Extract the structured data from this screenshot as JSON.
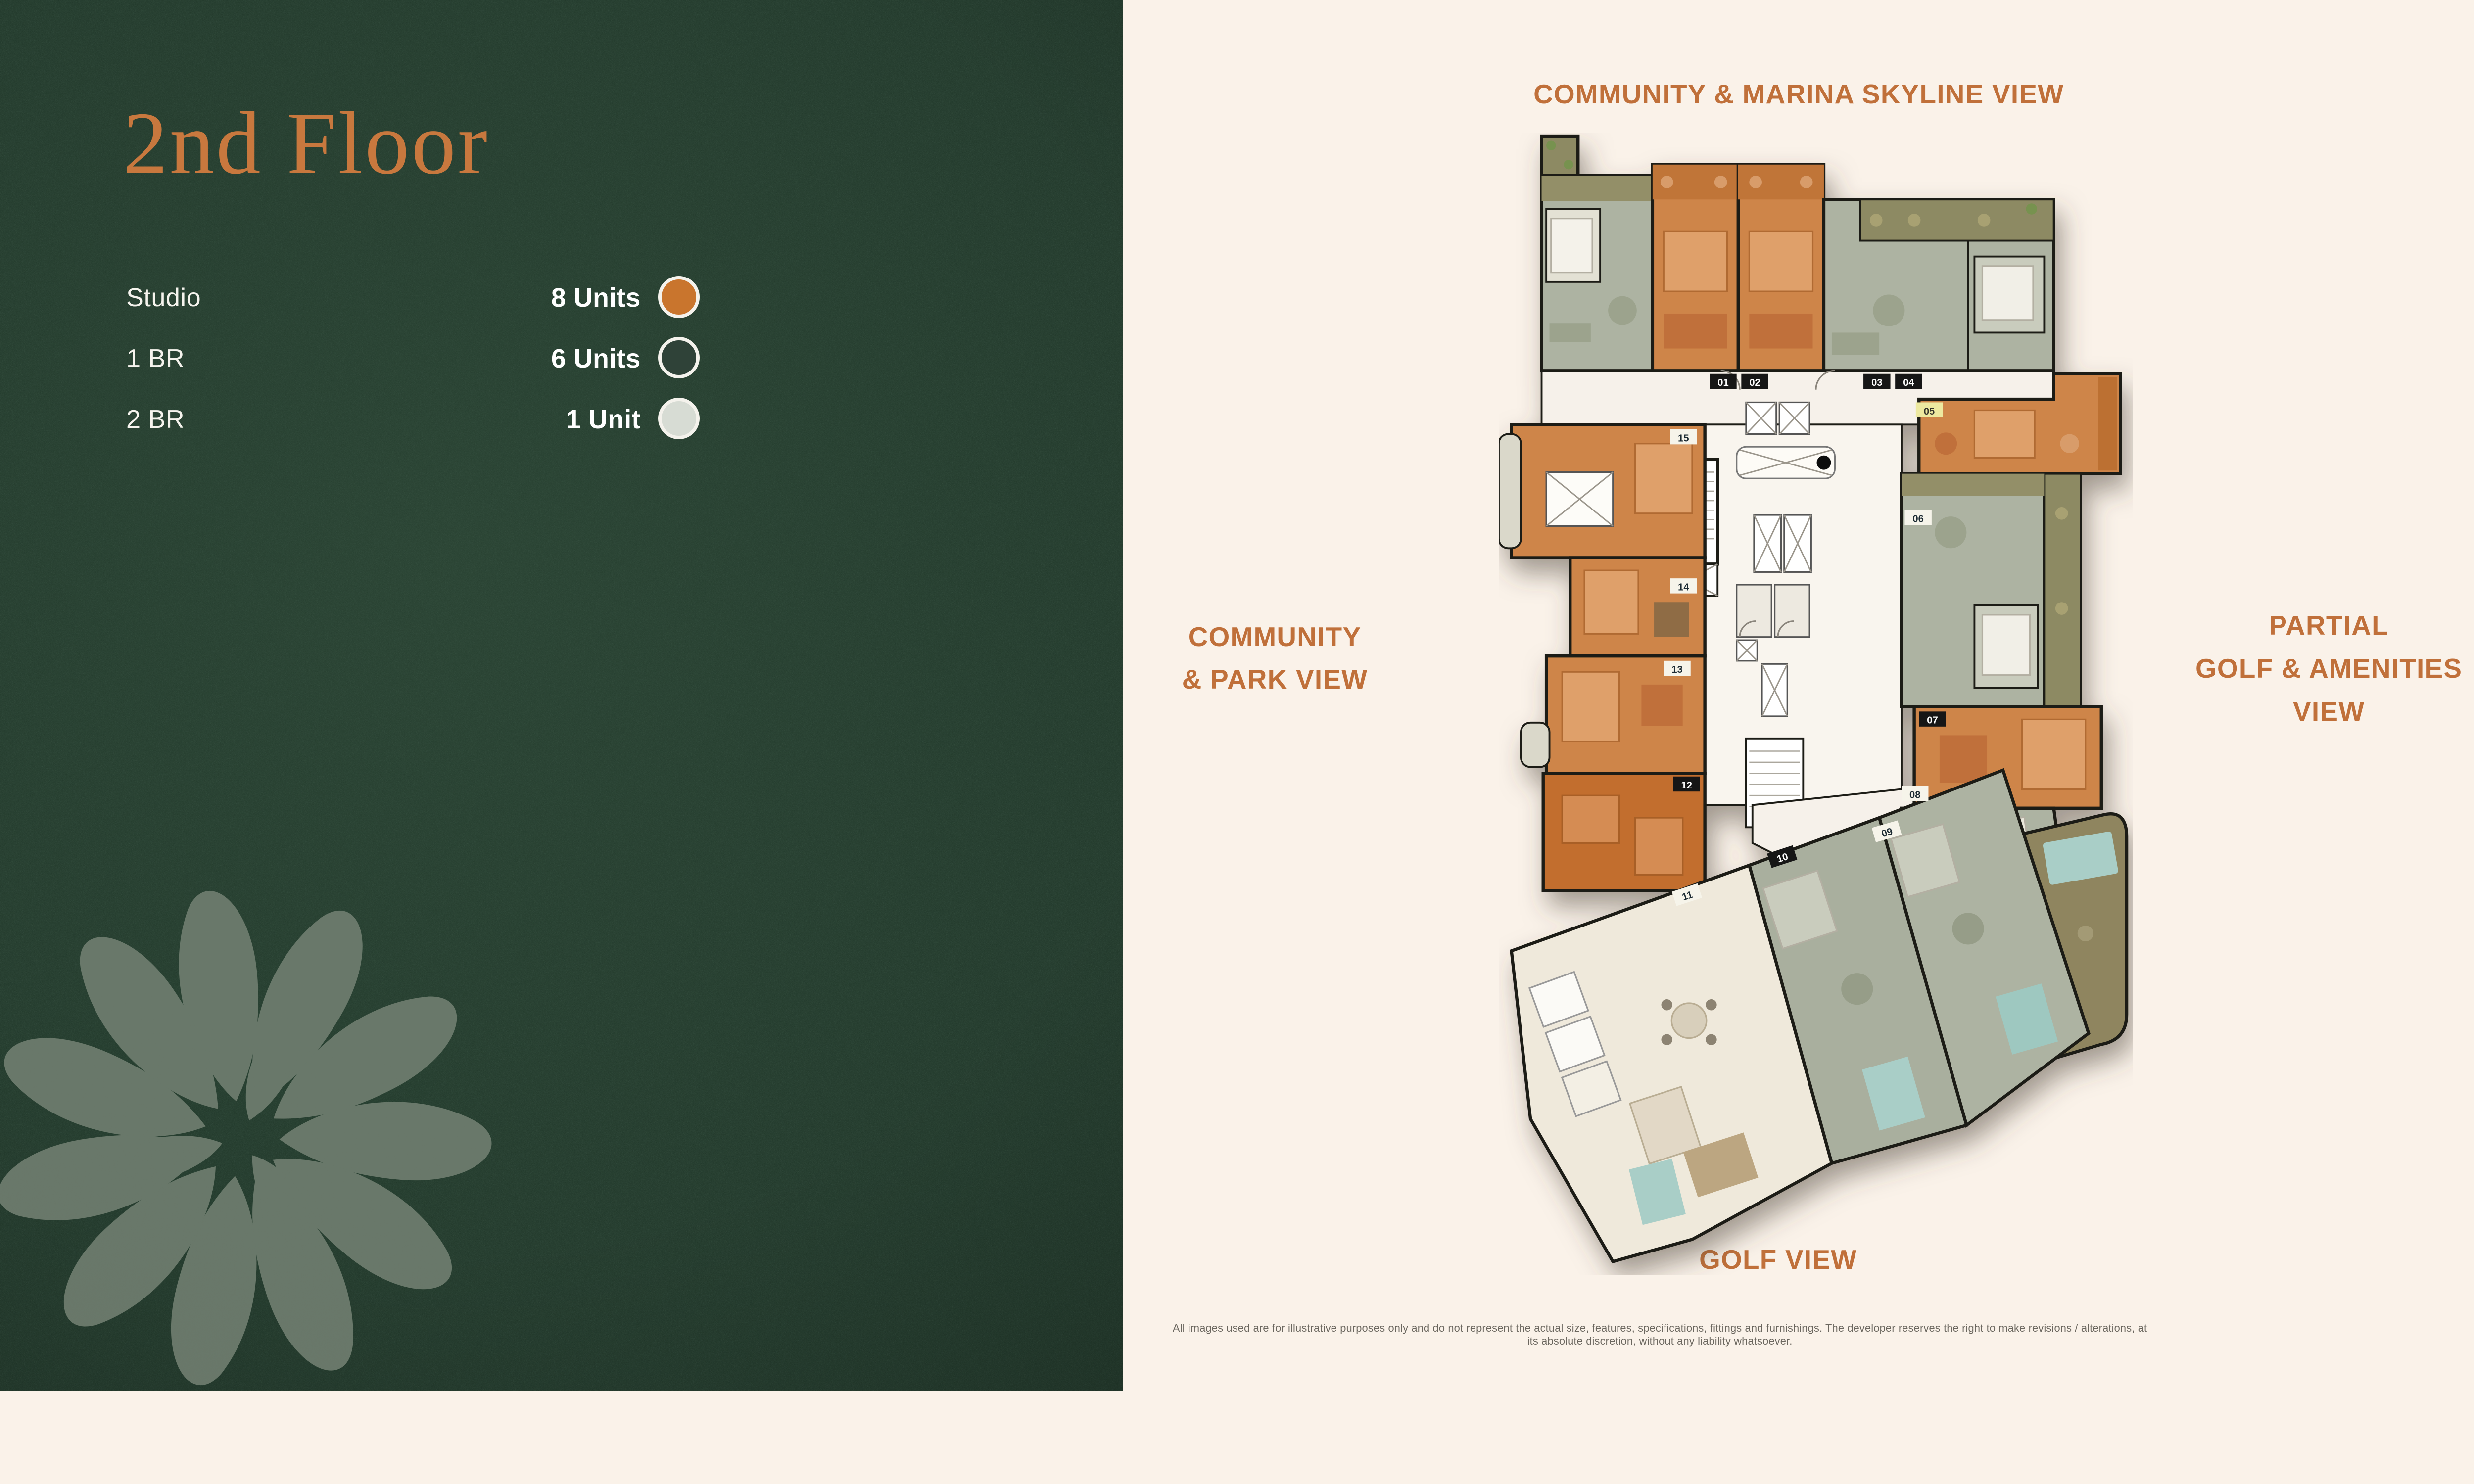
{
  "left_panel": {
    "title": "2nd Floor",
    "legend": [
      {
        "label": "Studio",
        "value": "8 Units",
        "color": "#C9752D"
      },
      {
        "label": "1 BR",
        "value": "6 Units",
        "color": "#2F4238"
      },
      {
        "label": "2 BR",
        "value": "1 Unit",
        "color": "#D7DCD4"
      }
    ]
  },
  "right_panel": {
    "view_labels": {
      "top": "COMMUNITY & MARINA SKYLINE VIEW",
      "left_line1": "COMMUNITY",
      "left_line2": "& PARK VIEW",
      "right_line1": "PARTIAL",
      "right_line2": "GOLF & AMENITIES",
      "right_line3": "VIEW",
      "bottom": "GOLF VIEW"
    },
    "disclaimer": "All images used are for illustrative purposes only and do not represent the actual size, features, specifications, fittings and furnishings. The developer reserves the right to make revisions / alterations, at its absolute discretion, without any liability whatsoever.",
    "floor_plan": {
      "units": [
        {
          "number": "01",
          "type": "1 BR"
        },
        {
          "number": "02",
          "type": "Studio"
        },
        {
          "number": "03",
          "type": "Studio"
        },
        {
          "number": "04",
          "type": "1 BR"
        },
        {
          "number": "05",
          "type": "Studio"
        },
        {
          "number": "06",
          "type": "1 BR"
        },
        {
          "number": "07",
          "type": "Studio"
        },
        {
          "number": "08",
          "type": "1 BR"
        },
        {
          "number": "09",
          "type": "1 BR"
        },
        {
          "number": "10",
          "type": "1 BR"
        },
        {
          "number": "11",
          "type": "2 BR"
        },
        {
          "number": "12",
          "type": "Studio"
        },
        {
          "number": "13",
          "type": "Studio"
        },
        {
          "number": "14",
          "type": "Studio"
        },
        {
          "number": "15",
          "type": "Studio"
        }
      ],
      "colors": {
        "studio": "#CE8549",
        "studio_dark": "#C26E2D",
        "one_br": "#ADB3A2",
        "two_br": "#EFE9DB",
        "balcony": "#8D8A63",
        "terrace_wood": "#8F855F",
        "pool": "#A9CEC7",
        "corridor": "#F6F1EA",
        "wall": "#1C1B15"
      }
    }
  }
}
